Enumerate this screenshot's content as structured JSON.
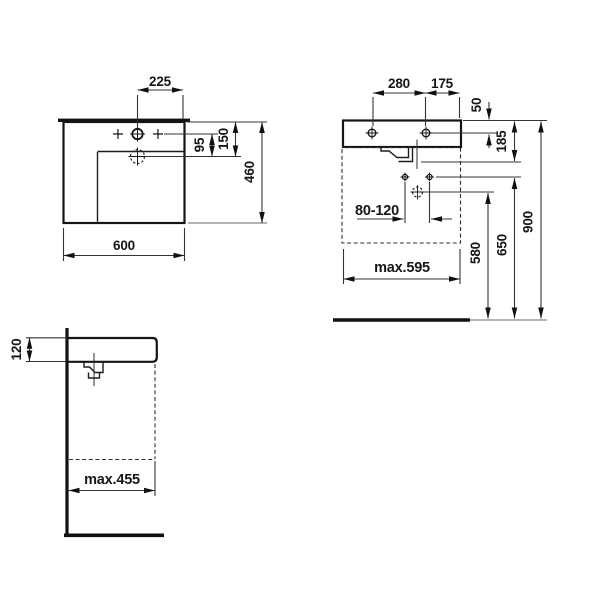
{
  "colors": {
    "line": "#161616",
    "background": "#ffffff"
  },
  "views": {
    "plan": {
      "dims": {
        "tap_spacing": "225",
        "drain_offset": "95",
        "drain_depth": "150",
        "depth": "460",
        "width": "600"
      }
    },
    "front": {
      "dims": {
        "hole_spacing": "280",
        "hole_to_edge": "175",
        "rim_to_holes": "50",
        "rim_to_overflow": "185",
        "drain_range": "80-120",
        "max_width_below": "max.595",
        "trap_height": "580",
        "fixing_height": "650",
        "mounting_height": "900"
      }
    },
    "side": {
      "dims": {
        "rim_thickness": "120",
        "max_depth_below": "max.455"
      }
    }
  }
}
